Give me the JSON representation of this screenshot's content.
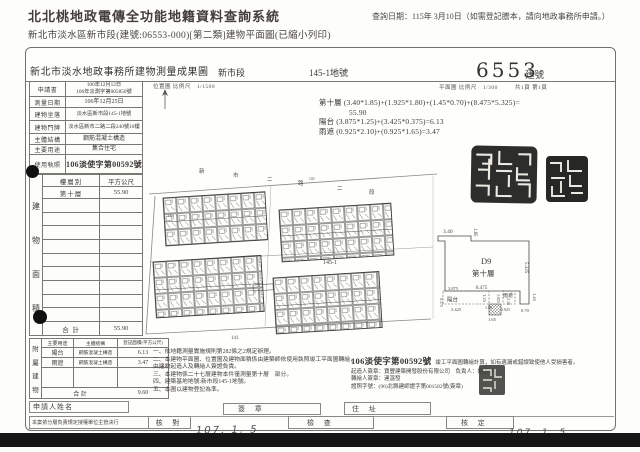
{
  "page": {
    "title": "北北桃地政電傳全功能地籍資料查詢系統",
    "subtitle": "新北市淡水區新市段(建號:06553-000)[第二類]建物平面圖(已縮小列印)",
    "query_date": "查詢日期：115年 3月10日（如需登記謄本，請向地政事務所申請。）"
  },
  "doc": {
    "title": "新北市淡水地政事務所建物測量成果圖",
    "section_name": "新市段",
    "parcel_no": "145-1地號",
    "building_no": "6553",
    "building_no_unit": "建號",
    "plan_scale": "平面圖 比例尺　1/300",
    "page_info": "共1頁 第1頁",
    "map_scale": "位置圖 比例尺　1/1500",
    "info_rows": [
      {
        "label": "申請書",
        "value": "106年12月12日",
        "value2": "106年淡測字第005850號"
      },
      {
        "label": "測量日期",
        "value": "106年12月25日"
      },
      {
        "label": "建物坐落",
        "value": "淡水區新市段145-1地號"
      },
      {
        "label": "建物門牌",
        "value": "淡水區新市二路二段240號10樓"
      },
      {
        "label": "主體結構",
        "value": "鋼筋混凝土構造"
      },
      {
        "label": "主要用途",
        "value": "集合住宅"
      },
      {
        "label": "使用執照",
        "value": "106淡使字第00592號"
      }
    ],
    "area_table": {
      "side_label": [
        "建",
        "物",
        "面",
        "積"
      ],
      "col_floor": "樓層別",
      "col_sqm": "平方公尺",
      "row_floor": "第十層",
      "row_sqm": "55.90",
      "total_label": "合 計",
      "total": "55.90"
    },
    "annex_table": {
      "side_label": [
        "附",
        "屬",
        "建",
        "物"
      ],
      "col_use": "主要用途",
      "col_structure": "主體結構",
      "col_area": "登記面積(平方公尺)",
      "rows": [
        {
          "use": "陽台",
          "structure": "鋼筋混凝土構造",
          "area": "6.13"
        },
        {
          "use": "雨遮",
          "structure": "鋼筋混凝土構造",
          "area": "3.47"
        }
      ],
      "total_label": "合 計",
      "total": "9.60"
    },
    "applicant_label": "申請人姓名",
    "delegate_note": "本案依分層負責規定授權單位主管決行",
    "check_label": "核 對",
    "sign_label": "簽 章",
    "address_label": "住 址",
    "inspect_label": "檢 查",
    "approve_label": "核 定",
    "date_stamp": "107. 1. 5",
    "calc": {
      "line1": "第十層 (3.40*1.85)+(1.925*1.80)+(1.45*0.70)+(8.475*5.325)=",
      "line2": "55.90",
      "line3": "陽台 (3.875*1.25)+(3.425*0.375)=6.13",
      "line4": "雨遮 (0.925*2.10)+(0.925*1.65)=3.47"
    },
    "map": {
      "street_chars": [
        "新",
        "市",
        "二",
        "路",
        "二",
        "段"
      ],
      "street_no": "140",
      "parcel_label": "145-1",
      "parcel_label2": "141",
      "parcel_label3": "149"
    },
    "detail": {
      "unit_id": "D9",
      "floor": "第十層",
      "balcony_label": "陽台",
      "shelter_label": "雨遮",
      "dims": {
        "top_w": "3.40",
        "top_h": "1.85",
        "right_h": "5.325",
        "mid_w": "8.475",
        "balc_w": "3.875",
        "balc_h": "1.25",
        "balc_w2": "3.425",
        "balc_off": "0.375",
        "seg_w": "1.925",
        "seg_h": "1.80",
        "rs_w": "0.925",
        "rs_h": "2.10",
        "rs_w2": "1.65",
        "r_h": "1.45",
        "r_w": "0.70"
      }
    },
    "notes": [
      "一、依地籍測量實施規則第282條之2規定辦理。",
      "二、本建物平面圖、位置圖及建物面積係由建築師依使用執照竣工平面圖轉繪，由建物起造人及轉繪人簽證負責。",
      "三、本建物係二十七層建物本件僅測量第十層　部分。",
      "四、建築基地地號:新市段145-1地號。",
      "五、本圖以建物登記為準。"
    ],
    "cert": {
      "no": "106淡使字第00592號",
      "line1": "竣工平面圖轉繪計算，如有遺漏或錯誤致使他人受損害者。",
      "line2": "起造人簽章：寶豐建築開發股份有限公司　負責人：紀玉柱",
      "line3": "轉繪人簽章：連溫發",
      "line4": "證照字號：(96)北縣建師證字第001582號(簽章)"
    }
  }
}
